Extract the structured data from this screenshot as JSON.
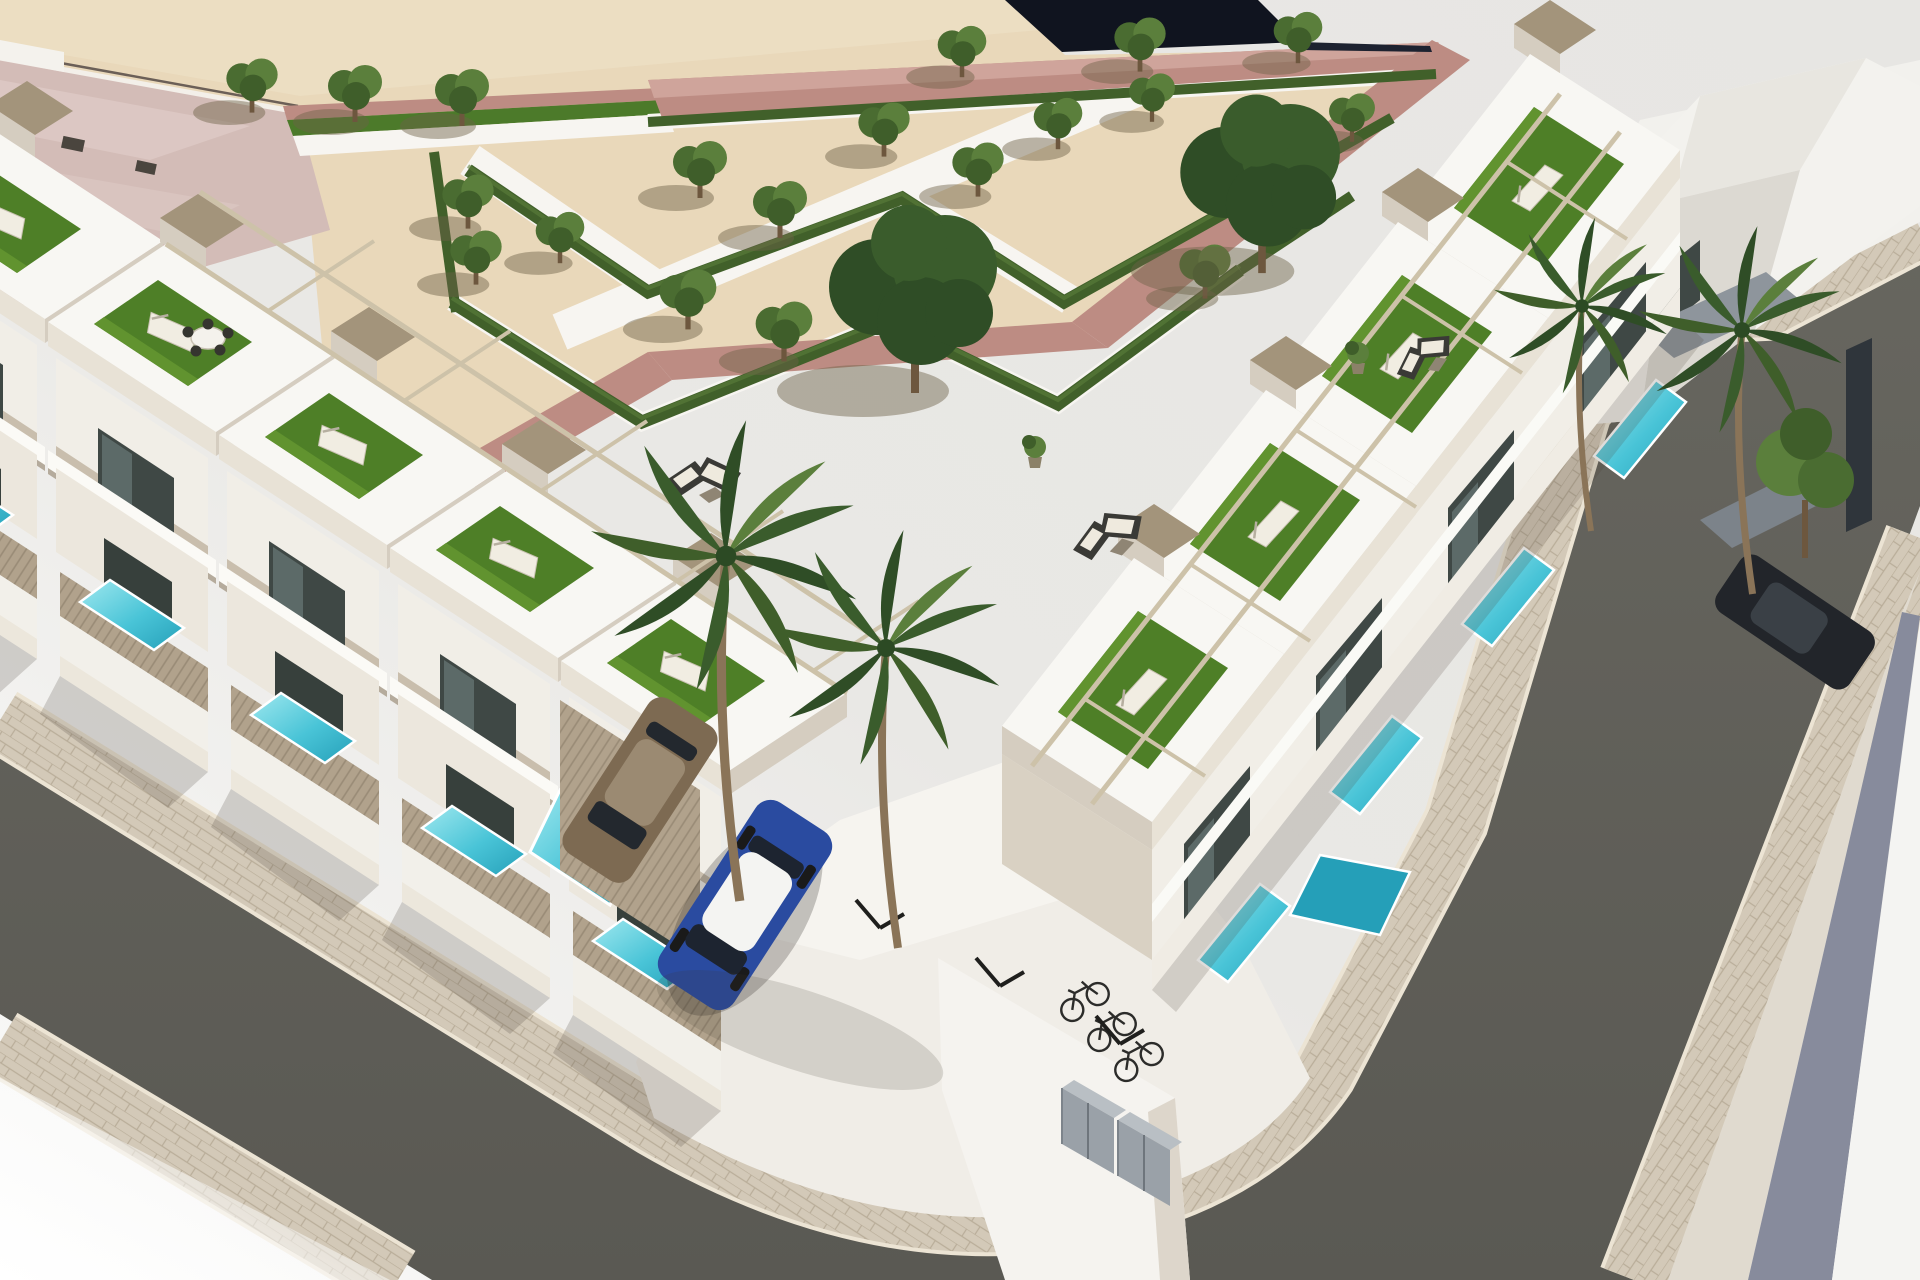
{
  "scene": {
    "type": "3d-architectural-render",
    "description": "Aerial 3D render of a modern white residential corner development: two rows of townhouses with rooftop turf terraces, pergolas and private plunge pools, a landscaped parterre park with hedges and trees behind, a pink-roofed plaza building, asphalt streets with paver sidewalks wrapping the corner, a parking court with cars, bicycles and storage lockers, and palm trees",
    "view": "aerial-oblique",
    "park": {
      "hedge_zigzag_rows": 2,
      "small_trees": 19,
      "large_dark_trees": 2,
      "promenade": "rose-pink path",
      "walks": "white gravel walks"
    },
    "buildings": {
      "left_row_units": 5,
      "right_row_units": 4,
      "corner_building": 1,
      "plaza_building_pink_roof": 1
    },
    "amenities": {
      "rooftop_terraces_with_turf": 9,
      "sun_loungers": 9,
      "plunge_pools": 11,
      "pergolas": 2,
      "bicycles": 3,
      "storage_lockers": 2,
      "parking_divider_posts": 3,
      "outdoor_sofa_sets": 3,
      "rooftop_dining_set": 1
    },
    "vehicles": {
      "blue_hatchback_white_roof": 1,
      "bronze_car": 1,
      "dark_car": 1
    },
    "vegetation": {
      "center_palms": 2,
      "right_palms": 2,
      "leafy_tree_right": 1
    }
  },
  "palette": {
    "bg": "#e8e7e4",
    "bgLight": "#fbfbfa",
    "sand": "#e9d8ba",
    "sandLight": "#f0e3c9",
    "pinkRoof": "#d3bcb7",
    "pinkRoofHi": "#e0ccc7",
    "pinkPath": "#bd8c83",
    "pinkPathHi": "#cfa49b",
    "navy": "#10141f",
    "pathWhite": "#f7f5f1",
    "hedge": "#41602a",
    "treeG1": "#4a6c31",
    "treeG2": "#5b7f3c",
    "treeG3": "#3f5e2a",
    "treeDark1": "#2f4d26",
    "treeDark2": "#3a5c2c",
    "trunk": "#6d573e",
    "shadow": "#6d6146",
    "asphalt": "#5a5953",
    "asphaltHi": "#67665f",
    "paver": "#d3c9b8",
    "paverLine": "#b9ad99",
    "curb": "#ece4d4",
    "wallLit": "#f8f7f3",
    "wallLit2": "#f1eee7",
    "wallFront": "#e8e2d6",
    "wallShade": "#d5cdc0",
    "wallMid": "#ece7dd",
    "wallMid2": "#d9d1c3",
    "glass": "#3f4845",
    "glassHi": "#5c6a68",
    "turf": "#4e7f27",
    "turfHi": "#61932f",
    "lounger": "#f1ede2",
    "pergola": "#cdc2a9",
    "tanCap": "#a3947b",
    "fence": "#b1a28c",
    "fenceLine": "#998b76",
    "pool": "#49c4d7",
    "poolHi": "#9fe8ef",
    "poolDeep": "#259fb8",
    "courtWhite": "#f0ede7",
    "carBlue": "#2a4ba0",
    "carRoof": "#f4f4f2",
    "carBronze": "#7d6a52",
    "carDark": "#22252a",
    "bike": "#2c2c2a",
    "locker": "#9aa1a8",
    "slate": "#878b9c",
    "grayCanopy": "#8e959c"
  }
}
